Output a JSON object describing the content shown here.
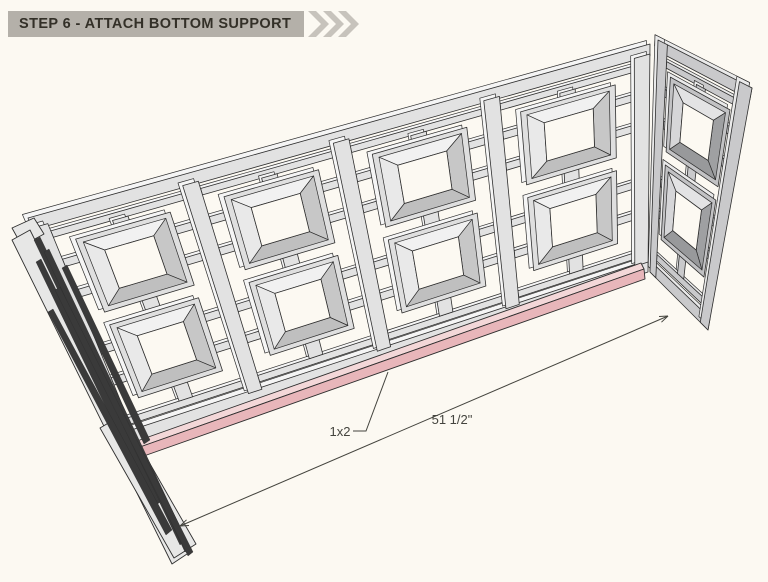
{
  "header": {
    "step_label": "STEP 6 - ATTACH BOTTOM SUPPORT"
  },
  "annotations": {
    "part_label": "1x2",
    "dimension_label": "51 1/2\""
  },
  "colors": {
    "background": "#fcf9f2",
    "header_bar": "#b4b0a9",
    "header_text": "#333028",
    "chevron": "#c7c3bc",
    "outline": "#2e2e2e",
    "dimension": "#44443e",
    "highlight_pink": "#e8b6ba",
    "highlight_pink_light": "#f3d7d8",
    "wood_face": "#e2e2e2",
    "wood_light": "#f5f5f5",
    "wood_band": "#dfdfdf",
    "wood_bevel_top": "#f1f1f1",
    "wood_bevel_left": "#e9e9e9",
    "wood_bevel_right": "#c7c7c7",
    "wood_bevel_bottom": "#bfbfbf",
    "side_face": "#c9c9cb",
    "side_light": "#eaeaea",
    "side_band": "#c2c2c4",
    "side_bevel_top": "#e3e3e4",
    "side_bevel_left": "#d6d6d8",
    "side_bevel_right": "#9fa0a2",
    "side_bevel_bottom": "#98999b",
    "edge_panel_light": "#e7e7e6",
    "edge_panel_dark": "#3a3a3a"
  }
}
